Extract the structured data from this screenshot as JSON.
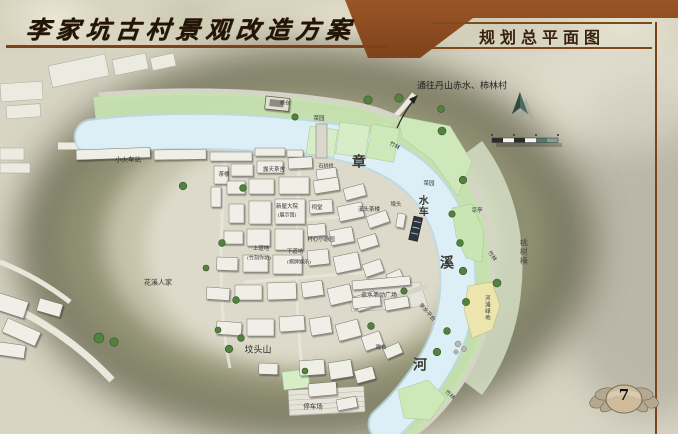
{
  "slide": {
    "title": "李家坑古村景观改造方案",
    "subtitle": "规划总平面图",
    "page_number": "7"
  },
  "map": {
    "direction_note": "通往丹山赤水、柿林村",
    "river_name": "章溪河",
    "labels": [
      {
        "text": "通往丹山赤水、柿林村",
        "x": 462,
        "y": 87,
        "size": 9,
        "color": "#222222"
      },
      {
        "text": "粮仓",
        "x": 285,
        "y": 104,
        "size": 5
      },
      {
        "text": "菜园",
        "x": 319,
        "y": 120,
        "size": 5.5
      },
      {
        "text": "竹林",
        "x": 394,
        "y": 147,
        "size": 5.5,
        "rotate": 30
      },
      {
        "text": "小火车站",
        "x": 128,
        "y": 160,
        "size": 6.5
      },
      {
        "text": "露天茶舍",
        "x": 274,
        "y": 171,
        "size": 5.5
      },
      {
        "text": "石拱桥",
        "x": 326,
        "y": 167,
        "size": 5
      },
      {
        "text": "茶楼",
        "x": 224,
        "y": 176,
        "size": 5.5
      },
      {
        "text": "章",
        "x": 359,
        "y": 163,
        "size": 14,
        "weight": "bold",
        "color": "#3a3a33"
      },
      {
        "text": "菜园",
        "x": 429,
        "y": 185,
        "size": 5.5
      },
      {
        "text": "埠头",
        "x": 396,
        "y": 206,
        "size": 5.5
      },
      {
        "text": "溪头茶楼",
        "x": 369,
        "y": 211,
        "size": 5.5
      },
      {
        "text": "水车",
        "x": 421,
        "y": 206,
        "size": 10,
        "vertical": true,
        "weight": "bold",
        "color": "#3a3a33"
      },
      {
        "text": "凉亭",
        "x": 477,
        "y": 212,
        "size": 5.5
      },
      {
        "text": "新屋大院",
        "x": 287,
        "y": 208,
        "size": 5.5
      },
      {
        "text": "(展示馆)",
        "x": 287,
        "y": 216,
        "size": 5
      },
      {
        "text": "祠堂",
        "x": 317,
        "y": 209,
        "size": 5.5
      },
      {
        "text": "村心小游园",
        "x": 321,
        "y": 241,
        "size": 5.5
      },
      {
        "text": "上道地",
        "x": 261,
        "y": 250,
        "size": 5.5
      },
      {
        "text": "(竹刻作坊)",
        "x": 259,
        "y": 259,
        "size": 5
      },
      {
        "text": "下道地",
        "x": 295,
        "y": 253,
        "size": 5.5
      },
      {
        "text": "(棋牌娱乐)",
        "x": 299,
        "y": 263,
        "size": 5
      },
      {
        "text": "溪",
        "x": 447,
        "y": 264,
        "size": 14,
        "weight": "bold",
        "color": "#3a3a33"
      },
      {
        "text": "竹林",
        "x": 491,
        "y": 257,
        "size": 5.5,
        "rotate": 55
      },
      {
        "text": "桃树横",
        "x": 523,
        "y": 252,
        "size": 8,
        "vertical": true,
        "color": "#4a4a40"
      },
      {
        "text": "花溪人家",
        "x": 158,
        "y": 283,
        "size": 7
      },
      {
        "text": "亲水活动广场",
        "x": 379,
        "y": 296,
        "size": 6
      },
      {
        "text": "亲水平台",
        "x": 426,
        "y": 313,
        "size": 5.5,
        "rotate": 50
      },
      {
        "text": "河滩绿地",
        "x": 486,
        "y": 308,
        "size": 5.5,
        "vertical": true
      },
      {
        "text": "坟头山",
        "x": 258,
        "y": 351,
        "size": 9,
        "color": "#2f2f28"
      },
      {
        "text": "戏台",
        "x": 381,
        "y": 349,
        "size": 5.5
      },
      {
        "text": "河",
        "x": 420,
        "y": 366,
        "size": 14,
        "weight": "bold",
        "color": "#3a3a33"
      },
      {
        "text": "停车场",
        "x": 313,
        "y": 407,
        "size": 6.5
      },
      {
        "text": "竹林",
        "x": 449,
        "y": 396,
        "size": 5.5,
        "rotate": 40
      }
    ],
    "icons": [
      "north-arrow",
      "scale-bar",
      "route-arrow"
    ]
  },
  "colors": {
    "accent_brown": "#80401a",
    "band_brown": "#8e4e20",
    "river": "#dceff7",
    "bank_green": "#c6e2b0",
    "patch_green": "#d6edc8",
    "tree_green": "#55813f",
    "olive_hill": "#7f7f63",
    "ground": "#d9d5c5",
    "building": "#f0efe7",
    "sand_patch": "#ece5ad"
  }
}
